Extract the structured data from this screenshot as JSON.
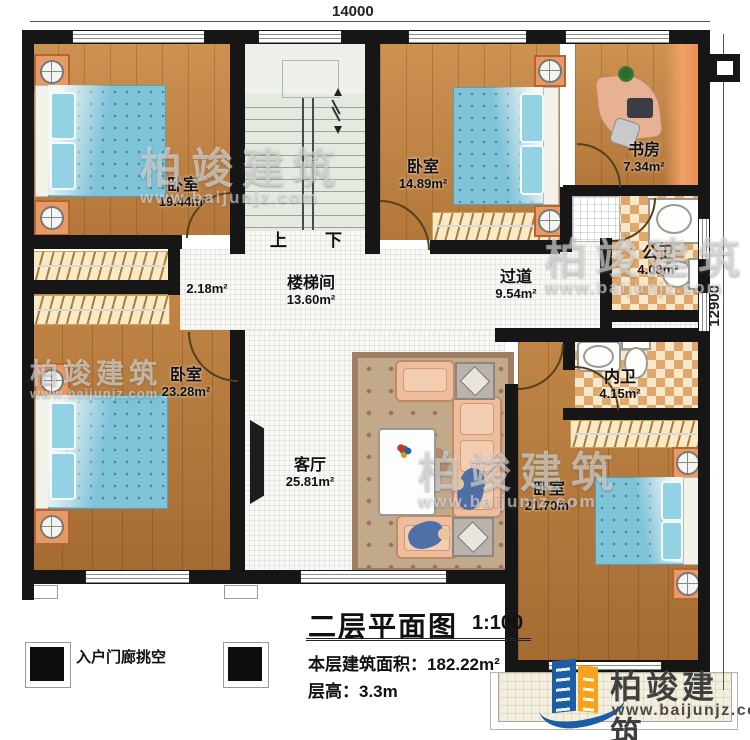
{
  "meta": {
    "title": "二层平面图",
    "scale": "1:100",
    "area_label": "本层建筑面积：",
    "area_value": "182.22m²",
    "floor_height_label": "层高：",
    "floor_height_value": "3.3m",
    "porch_label": "入户门廊挑空"
  },
  "dimensions": {
    "top": "14000",
    "right": "12900"
  },
  "stairs": {
    "up": "上",
    "down": "下"
  },
  "rooms": [
    {
      "id": "bedroom-nw",
      "name": "卧室",
      "area": "19.44m²"
    },
    {
      "id": "stairwell",
      "name": "楼梯间",
      "area": "13.60m²"
    },
    {
      "id": "bedroom-n",
      "name": "卧室",
      "area": "14.89m²"
    },
    {
      "id": "study",
      "name": "书房",
      "area": "7.34m²"
    },
    {
      "id": "public-bath",
      "name": "公卫",
      "area": "4.08m²"
    },
    {
      "id": "hallway",
      "name": "过道",
      "area": "9.54m²"
    },
    {
      "id": "nook",
      "name": "",
      "area": "2.18m²"
    },
    {
      "id": "bedroom-sw",
      "name": "卧室",
      "area": "23.28m²"
    },
    {
      "id": "ensuite-bath",
      "name": "内卫",
      "area": "4.15m²"
    },
    {
      "id": "living-room",
      "name": "客厅",
      "area": "25.81m²"
    },
    {
      "id": "bedroom-se",
      "name": "卧室",
      "area": "21.70m²"
    }
  ],
  "watermark": {
    "brand": "柏竣建筑",
    "url": "www.baijunjz.com"
  },
  "logo": {
    "brand": "柏竣建筑",
    "url": "www.baijunjz.com"
  },
  "colors": {
    "wall": "#161616",
    "wood": "#c28343",
    "bed_blue": "#7fc3d9",
    "bath_checker": "#dfa76c",
    "stair_floor": "#e3eadf",
    "logo_blue": "#1b5ea6",
    "logo_orange": "#f5a31a"
  }
}
